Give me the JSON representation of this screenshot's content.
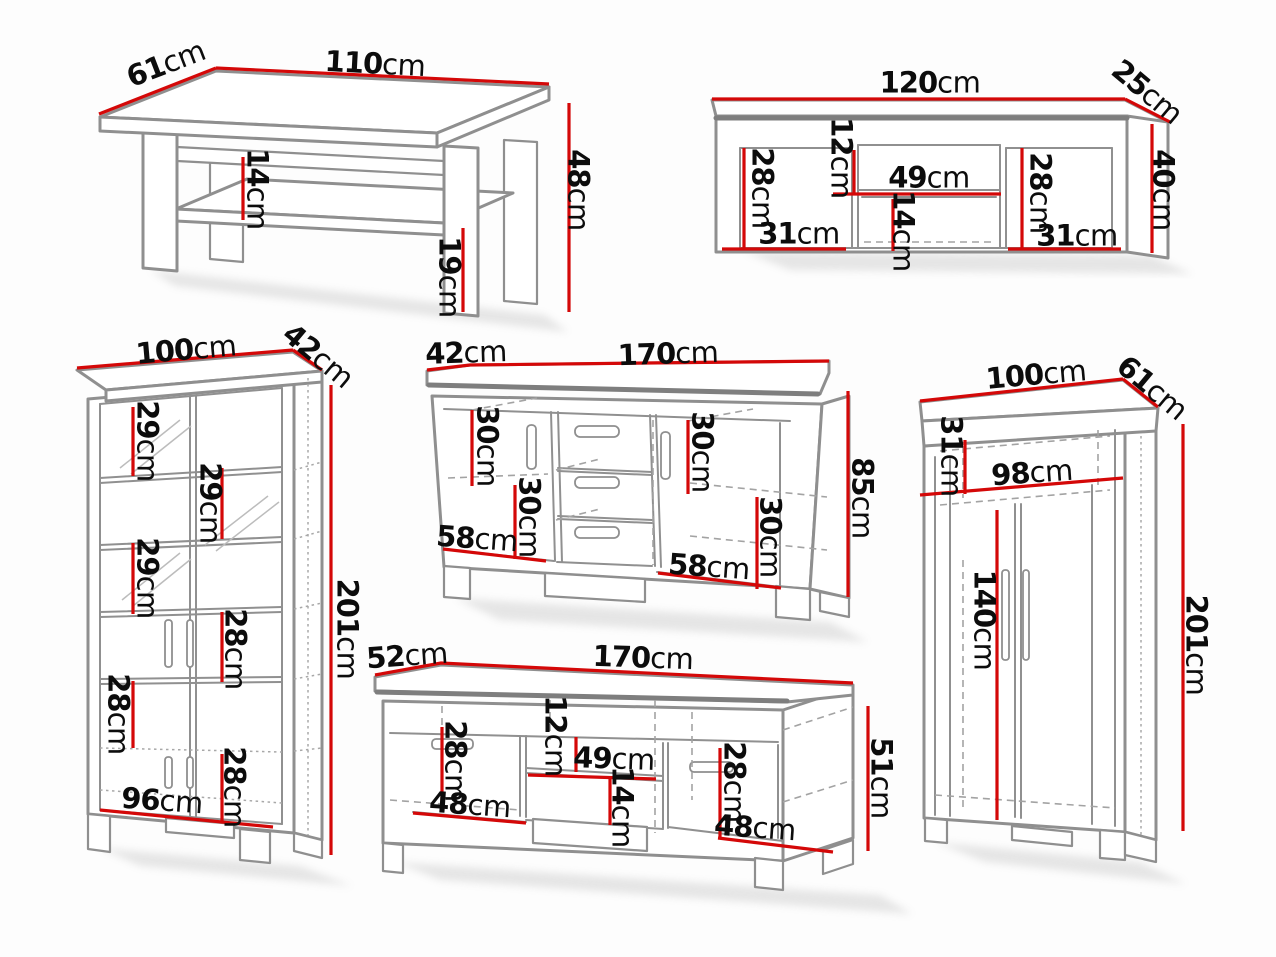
{
  "colors": {
    "background": "#fdfdfd",
    "furniture_outline": "#8f8f8f",
    "dimension_line": "#d40808",
    "label_text": "#0c0c0c"
  },
  "furniture": [
    {
      "id": "coffee-table",
      "labels": {
        "width": {
          "v": "110",
          "u": "cm"
        },
        "depth": {
          "v": "61",
          "u": "cm"
        },
        "height": {
          "v": "48",
          "u": "cm"
        },
        "shelf_gap": {
          "v": "14",
          "u": "cm"
        },
        "leg_space": {
          "v": "19",
          "u": "cm"
        }
      }
    },
    {
      "id": "wall-shelf",
      "labels": {
        "width": {
          "v": "120",
          "u": "cm"
        },
        "depth": {
          "v": "25",
          "u": "cm"
        },
        "height": {
          "v": "40",
          "u": "cm"
        },
        "left_height": {
          "v": "28",
          "u": "cm"
        },
        "left_width": {
          "v": "31",
          "u": "cm"
        },
        "niche_top": {
          "v": "12",
          "u": "cm"
        },
        "niche_width": {
          "v": "49",
          "u": "cm"
        },
        "niche_bottom": {
          "v": "14",
          "u": "cm"
        },
        "right_height": {
          "v": "28",
          "u": "cm"
        },
        "right_width": {
          "v": "31",
          "u": "cm"
        }
      }
    },
    {
      "id": "display-cabinet",
      "labels": {
        "width": {
          "v": "100",
          "u": "cm"
        },
        "depth": {
          "v": "42",
          "u": "cm"
        },
        "height": {
          "v": "201",
          "u": "cm"
        },
        "shelf_1": {
          "v": "29",
          "u": "cm"
        },
        "shelf_2": {
          "v": "29",
          "u": "cm"
        },
        "shelf_3": {
          "v": "29",
          "u": "cm"
        },
        "shelf_4": {
          "v": "28",
          "u": "cm"
        },
        "shelf_5": {
          "v": "28",
          "u": "cm"
        },
        "shelf_6": {
          "v": "28",
          "u": "cm"
        },
        "inner_width": {
          "v": "96",
          "u": "cm"
        }
      }
    },
    {
      "id": "sideboard",
      "labels": {
        "depth": {
          "v": "42",
          "u": "cm"
        },
        "width": {
          "v": "170",
          "u": "cm"
        },
        "height": {
          "v": "85",
          "u": "cm"
        },
        "left_top": {
          "v": "30",
          "u": "cm"
        },
        "left_bottom": {
          "v": "30",
          "u": "cm"
        },
        "left_width": {
          "v": "58",
          "u": "cm"
        },
        "right_top": {
          "v": "30",
          "u": "cm"
        },
        "right_bottom": {
          "v": "30",
          "u": "cm"
        },
        "right_width": {
          "v": "58",
          "u": "cm"
        }
      }
    },
    {
      "id": "tv-stand",
      "labels": {
        "depth": {
          "v": "52",
          "u": "cm"
        },
        "width": {
          "v": "170",
          "u": "cm"
        },
        "height": {
          "v": "51",
          "u": "cm"
        },
        "left_height": {
          "v": "28",
          "u": "cm"
        },
        "niche_top": {
          "v": "12",
          "u": "cm"
        },
        "niche_width": {
          "v": "49",
          "u": "cm"
        },
        "niche_bottom": {
          "v": "14",
          "u": "cm"
        },
        "left_width": {
          "v": "48",
          "u": "cm"
        },
        "right_height": {
          "v": "28",
          "u": "cm"
        },
        "right_width": {
          "v": "48",
          "u": "cm"
        }
      }
    },
    {
      "id": "wardrobe",
      "labels": {
        "width": {
          "v": "100",
          "u": "cm"
        },
        "depth": {
          "v": "61",
          "u": "cm"
        },
        "height": {
          "v": "201",
          "u": "cm"
        },
        "top_shelf": {
          "v": "31",
          "u": "cm"
        },
        "inner_width": {
          "v": "98",
          "u": "cm"
        },
        "hanging_space": {
          "v": "140",
          "u": "cm"
        }
      }
    }
  ]
}
